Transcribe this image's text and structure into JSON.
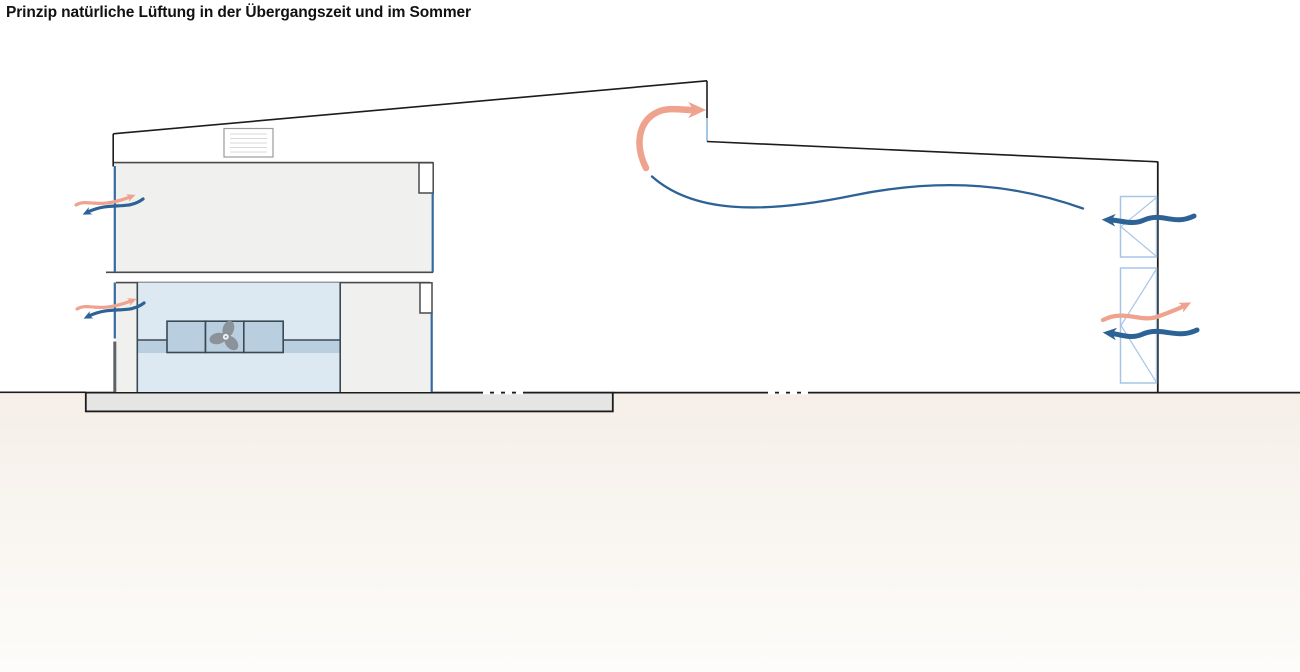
{
  "title": "Prinzip natürliche Lüftung in der Übergangszeit und im Sommer",
  "diagram_type": "architectural-section-natural-ventilation-scheme",
  "colors": {
    "line_dark": "#1c1c1c",
    "border_gray": "#4a4a4a",
    "wall_gray": "#5f6368",
    "room_fill": "#f0f0ee",
    "pool_fill": "#dce9f2",
    "band_fill": "#b9cfdf",
    "unit_outline": "#394a54",
    "fan_gray": "#8b9299",
    "slab_fill": "#e5e5e3",
    "ground_beige": "#f5efe8",
    "ground_fade": "#fdfcfa",
    "facade_glass": "#36699f",
    "window_symbol": "#a6c6e7",
    "skylight_border": "#9b9b9b",
    "skylight_lines": "#d9d9d9",
    "warm_air": "#efa28e",
    "cool_air": "#2d6297"
  },
  "icons": {
    "fan-icon": "3-blade-propeller",
    "skylight-vent-icon": "louvered-roof-vent-box",
    "vent-window-icon": "pivot-window-triangle-symbol",
    "warm-air-arrow": "curved-swoosh-arrow",
    "cool-air-arrow": "curved-swoosh-arrow"
  }
}
